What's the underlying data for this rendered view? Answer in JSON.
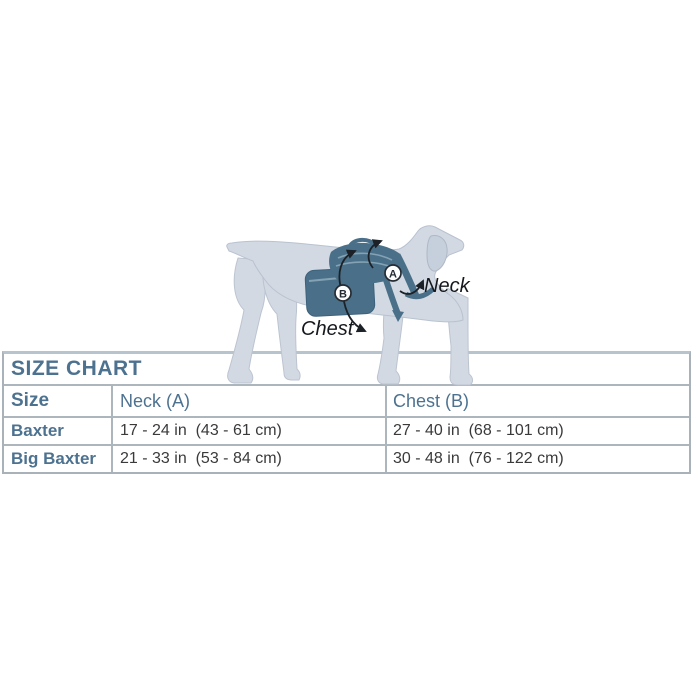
{
  "illustration": {
    "neck_label": "Neck",
    "chest_label": "Chest",
    "marker_a": "A",
    "marker_b": "B"
  },
  "table": {
    "title": "SIZE CHART",
    "columns": {
      "size": "Size",
      "neck": "Neck (A)",
      "chest": "Chest (B)"
    },
    "rows": [
      {
        "size": "Baxter",
        "neck": "17 - 24 in  (43 - 61 cm)",
        "chest": "27 - 40 in  (68 - 101 cm)"
      },
      {
        "size": "Big Baxter",
        "neck": "21 - 33 in  (53 - 84 cm)",
        "chest": "30 - 48 in  (76 - 122 cm)"
      }
    ]
  },
  "colors": {
    "heading_text": "#4d7290",
    "data_text": "#3a3a3a",
    "table_border": "#adb5bd",
    "dog_body": "#d2d9e3",
    "dog_outline": "#b9c2cf",
    "harness": "#4a7089",
    "harness_light": "#84a2b4",
    "annotation": "#1c2127"
  }
}
